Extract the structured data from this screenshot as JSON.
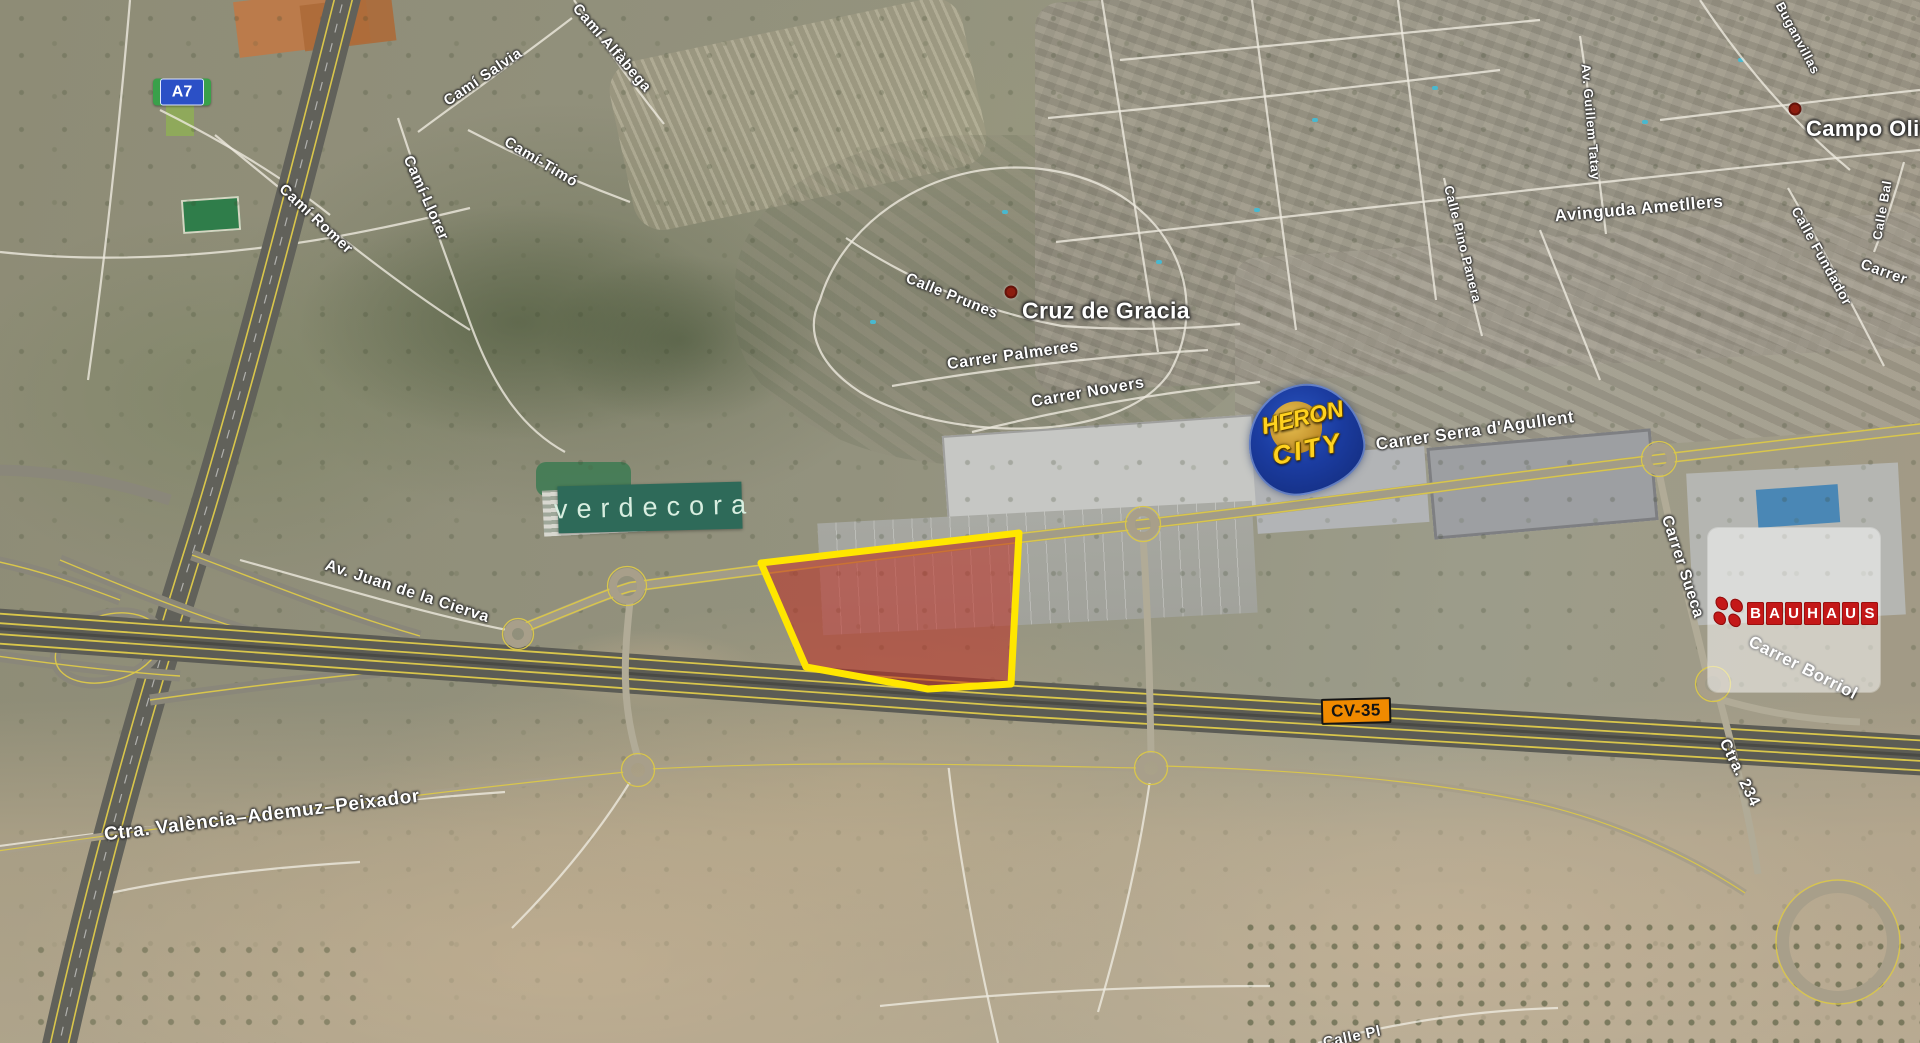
{
  "map": {
    "shields": [
      {
        "id": "a7",
        "label": "A7",
        "type": "motorway-blue-green"
      },
      {
        "id": "cv35",
        "label": "CV-35",
        "type": "regional-orange"
      }
    ],
    "place_labels": [
      {
        "text": "Cruz de Gracia",
        "x": 1022,
        "y": 311,
        "size": 23,
        "anchor": "left"
      },
      {
        "text": "Campo Oliv",
        "x": 1806,
        "y": 129,
        "size": 22,
        "anchor": "left"
      }
    ],
    "place_dots": [
      {
        "x": 1011,
        "y": 292
      },
      {
        "x": 1795,
        "y": 109
      }
    ],
    "road_labels": [
      {
        "text": "Camí Romer",
        "x": 316,
        "y": 219,
        "rot": 43,
        "size": 15
      },
      {
        "text": "Camí-Llorer",
        "x": 426,
        "y": 198,
        "rot": 66,
        "size": 15
      },
      {
        "text": "Camí Salvia",
        "x": 483,
        "y": 77,
        "rot": -34,
        "size": 15
      },
      {
        "text": "Camí Alfàbega",
        "x": 612,
        "y": 48,
        "rot": 49,
        "size": 15
      },
      {
        "text": "Camí-Timó",
        "x": 541,
        "y": 162,
        "rot": 31,
        "size": 15
      },
      {
        "text": "Calle Prunes",
        "x": 952,
        "y": 296,
        "rot": 22,
        "size": 15
      },
      {
        "text": "Carrer Palmeres",
        "x": 1013,
        "y": 356,
        "rot": -8,
        "size": 16
      },
      {
        "text": "Carrer Novers",
        "x": 1088,
        "y": 393,
        "rot": -10,
        "size": 16
      },
      {
        "text": "Carrer Serra d'Agullent",
        "x": 1475,
        "y": 431,
        "rot": -8,
        "size": 17
      },
      {
        "text": "Calle Pino Panera",
        "x": 1463,
        "y": 244,
        "rot": 76,
        "size": 13
      },
      {
        "text": "Av. Guillem Tatay",
        "x": 1591,
        "y": 122,
        "rot": 85,
        "size": 13
      },
      {
        "text": "Avinguda Ametllers",
        "x": 1639,
        "y": 209,
        "rot": -5,
        "size": 17
      },
      {
        "text": "Buganvillas",
        "x": 1798,
        "y": 38,
        "rot": 62,
        "size": 13
      },
      {
        "text": "Calle Fundador",
        "x": 1822,
        "y": 256,
        "rot": 61,
        "size": 14
      },
      {
        "text": "Calle Bal",
        "x": 1882,
        "y": 210,
        "rot": -80,
        "size": 13
      },
      {
        "text": "Carrer",
        "x": 1884,
        "y": 272,
        "rot": 20,
        "size": 15
      },
      {
        "text": "Av. Juan de la Cierva",
        "x": 407,
        "y": 592,
        "rot": 18,
        "size": 16
      },
      {
        "text": "Carrer Sueca",
        "x": 1682,
        "y": 567,
        "rot": 72,
        "size": 16
      },
      {
        "text": "Carrer Borriol",
        "x": 1803,
        "y": 668,
        "rot": 27,
        "size": 17
      },
      {
        "text": "Ctra. 234",
        "x": 1739,
        "y": 773,
        "rot": 64,
        "size": 16
      },
      {
        "text": "Ctra. València–Ademuz–Peixador",
        "x": 262,
        "y": 816,
        "rot": -7,
        "size": 19
      },
      {
        "text": "Calle Pl",
        "x": 1352,
        "y": 1037,
        "rot": -12,
        "size": 15
      }
    ],
    "logos": {
      "verdecora": {
        "text": "verdecora",
        "bg": "#2e6a59",
        "fg": "#d8eee0"
      },
      "heron_city": {
        "line1": "HERON",
        "line2": "CITY",
        "bg": "#16338f",
        "fg": "#ffd21f"
      },
      "bauhaus": {
        "text": "BAUHAUS",
        "tile": "#c41818",
        "fg": "#ffffff"
      }
    },
    "highlight": {
      "points": "761,563 1019,533 1011,684 928,689 806,667",
      "fill": "rgba(190,45,35,0.55)",
      "stroke": "#ffe600",
      "stroke_width": 7
    },
    "colors": {
      "road_line_yellow": "#d9c64b",
      "highway_gray": "#5c5c55",
      "a7_blue": "#2b50c6",
      "a7_green": "#3aa04a",
      "cv35_orange": "#f08a00"
    }
  }
}
